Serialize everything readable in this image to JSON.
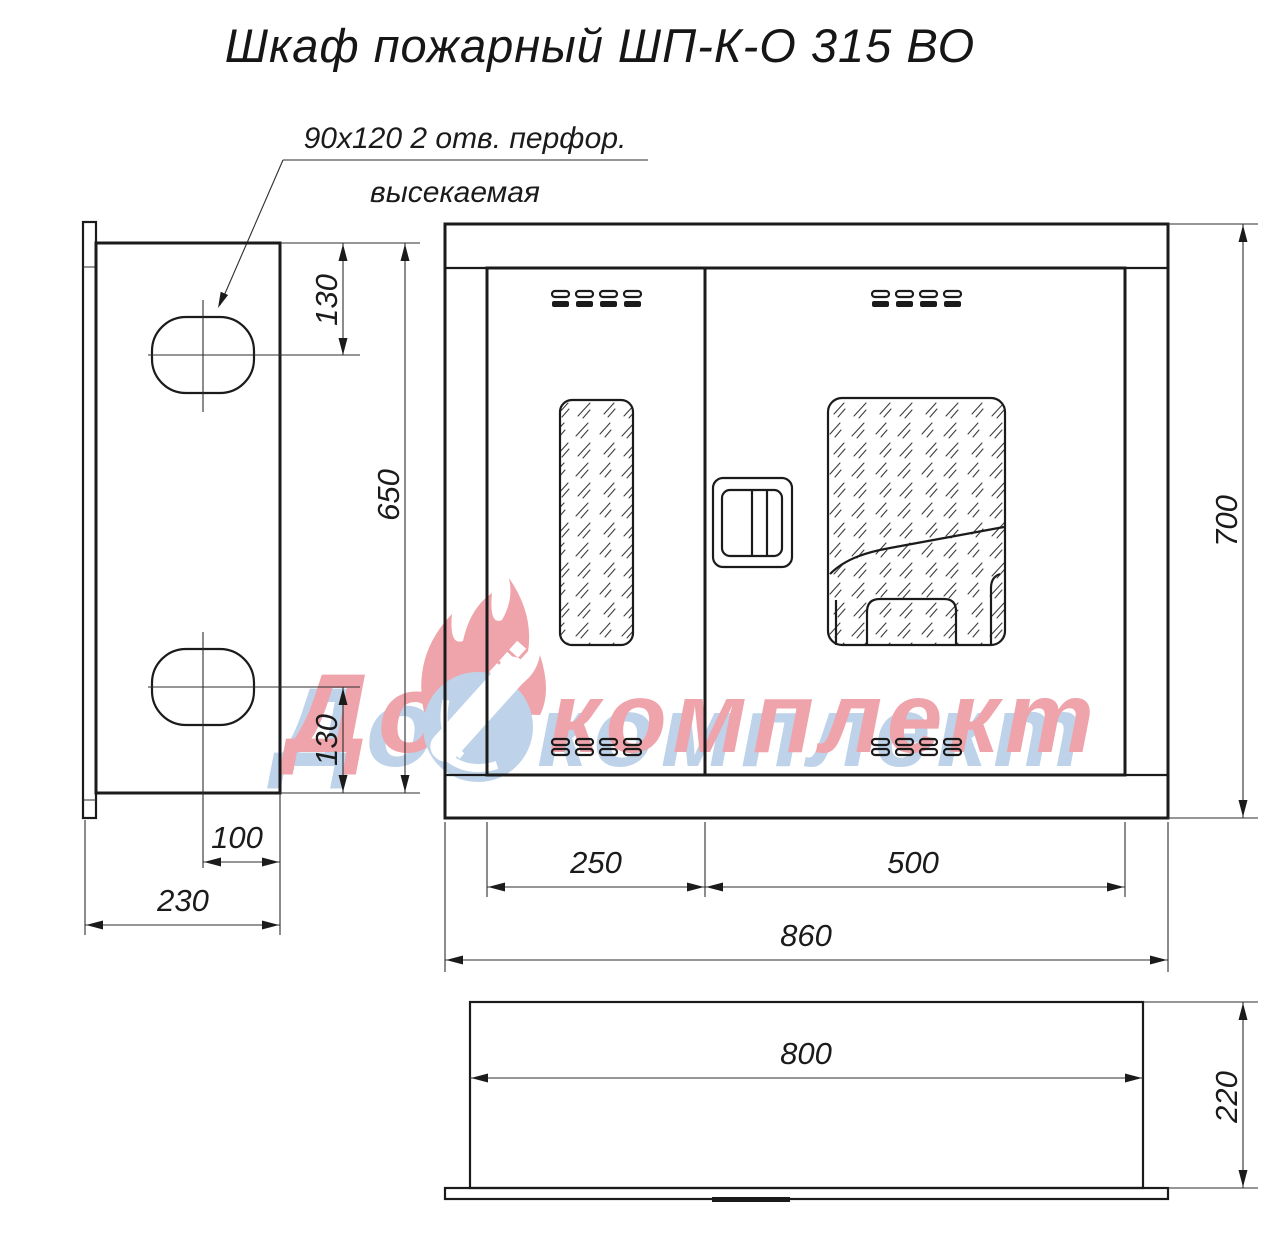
{
  "title": "Шкаф пожарный ШП-К-О 315 ВО",
  "annotation": {
    "line1": "90x120  2 отв. перфор.",
    "line2": "высекаемая"
  },
  "dims": {
    "side_hole_top": "130",
    "side_height": "650",
    "side_hole_bottom": "130",
    "side_hole_offset": "100",
    "side_depth": "230",
    "front_height": "700",
    "door_left_width": "250",
    "door_right_width": "500",
    "front_width": "860",
    "top_width": "800",
    "top_depth": "220"
  },
  "watermark": {
    "word1": "Дон",
    "word2": "комплект",
    "red": "#e04a58",
    "blue": "#7fa9d6"
  },
  "colors": {
    "line": "#1b1b1b",
    "background": "#ffffff"
  }
}
